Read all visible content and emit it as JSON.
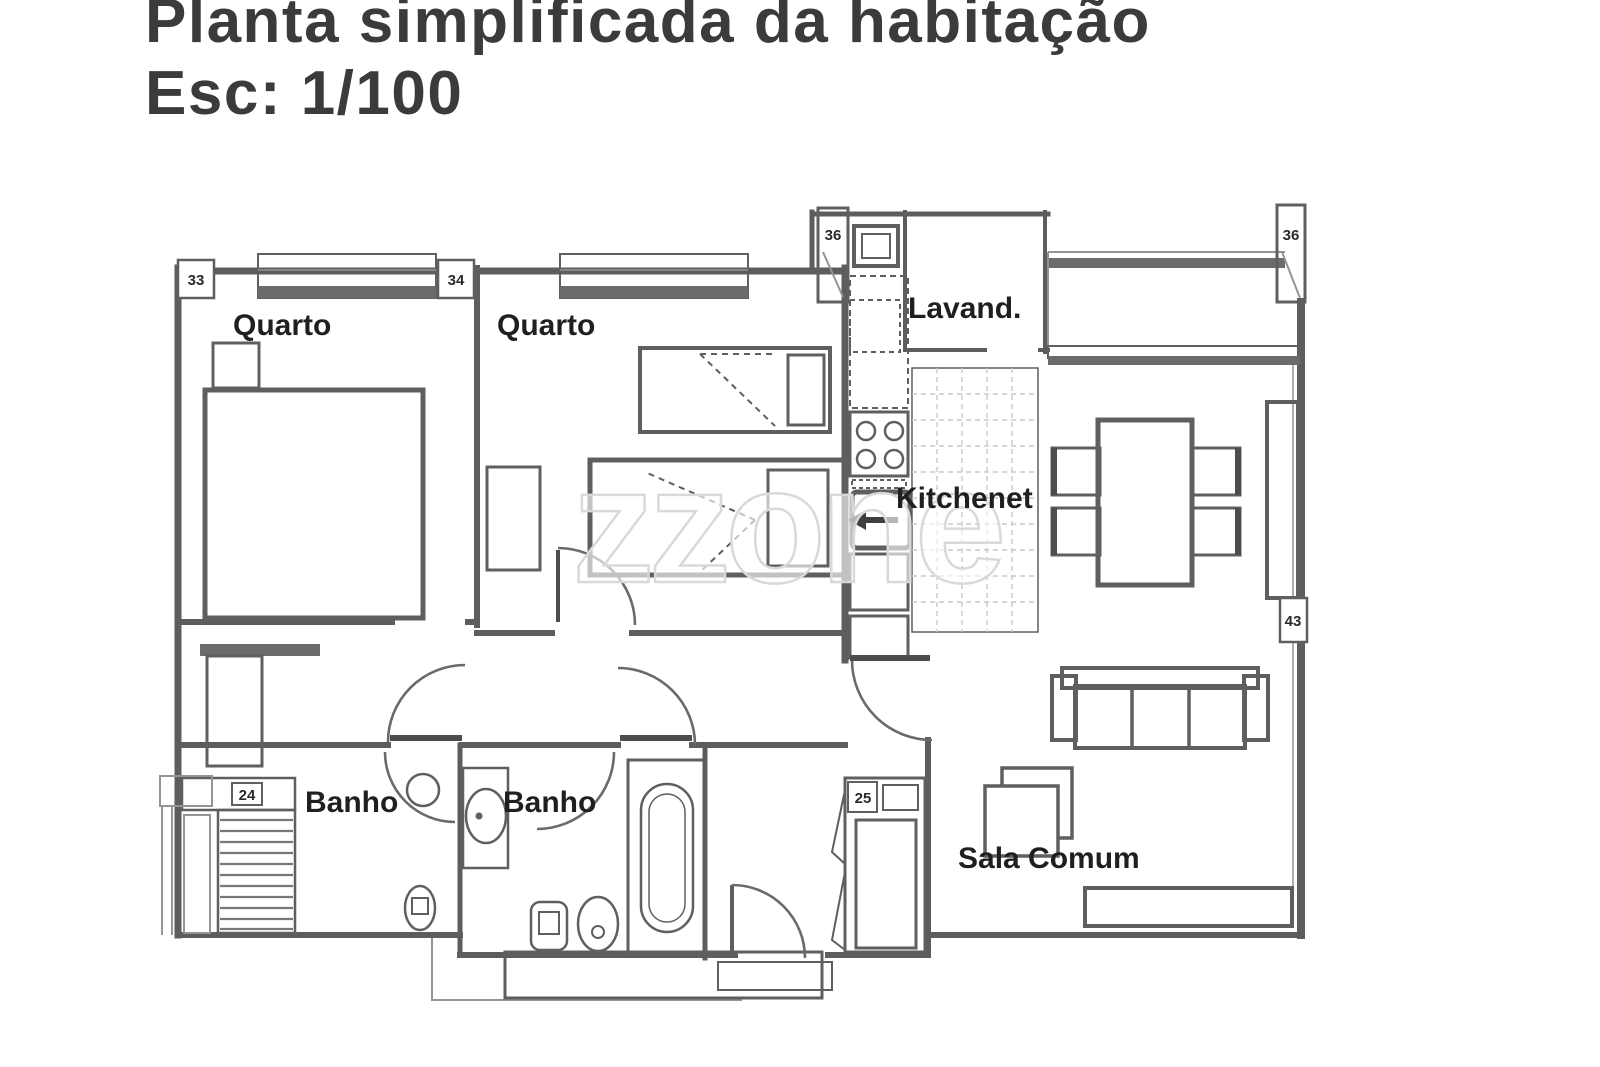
{
  "title": {
    "line1": "Planta simplificada da habitação",
    "line2": "Esc: 1/100"
  },
  "watermark": "zzone",
  "rooms": {
    "quarto1": "Quarto",
    "quarto2": "Quarto",
    "lavandaria": "Lavand.",
    "kitchenet": "Kitchenet",
    "banho1": "Banho",
    "banho2": "Banho",
    "sala_comum": "Sala Comum"
  },
  "markers": {
    "window_left": "33",
    "window_mid": "34",
    "duct_top": "36",
    "column_right": "36",
    "heater_closet": "24",
    "hall_cabinet": "25",
    "wall_right": "43"
  },
  "colors": {
    "wall_line": "#5d5d5d",
    "label_text": "#1f1f1f",
    "watermark": "#d9d9d9",
    "tile_grid": "#c9c9c9",
    "title_text": "#3b3b3b",
    "background": "#ffffff"
  }
}
